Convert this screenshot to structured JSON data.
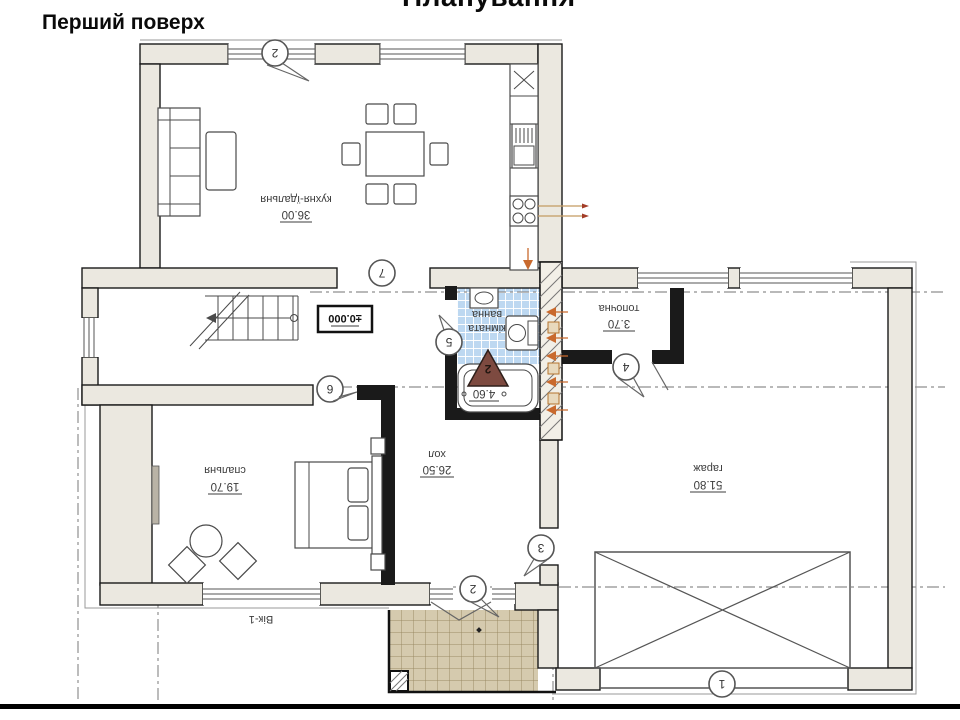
{
  "slide": {
    "title": "Планування",
    "subtitle": "Перший поверх"
  },
  "rooms": {
    "kitchen": {
      "name": "кухня-їдальня",
      "area": "36.00"
    },
    "bathroom": {
      "name_line1": "ванна",
      "name_line2": "кімната",
      "area": "4.60"
    },
    "boiler": {
      "name": "топочна",
      "area": "3.70"
    },
    "bedroom": {
      "name": "спальня",
      "area": "19.70"
    },
    "hall": {
      "name": "хол",
      "area": "26.50"
    },
    "garage": {
      "name": "гараж",
      "area": "51.80"
    }
  },
  "annotations": {
    "level_mark": "±0.000",
    "window_tag": "Вік-1",
    "section_mark": "2"
  },
  "markers": {
    "top_window": "2",
    "kitchen_axis": "7",
    "bedroom_door": "6",
    "bath_door": "5",
    "boiler_door": "4",
    "entry_side": "3",
    "entry_door": "2",
    "garage_axis": "1"
  },
  "colors": {
    "wall_fill": "#ebe8e0",
    "line": "#1a1a1a",
    "bath_tile": "#bdd8f1",
    "porch_tile": "#d5caae",
    "section_triangle": "#7d4a40",
    "flue_arrow": "#c96a2e"
  }
}
